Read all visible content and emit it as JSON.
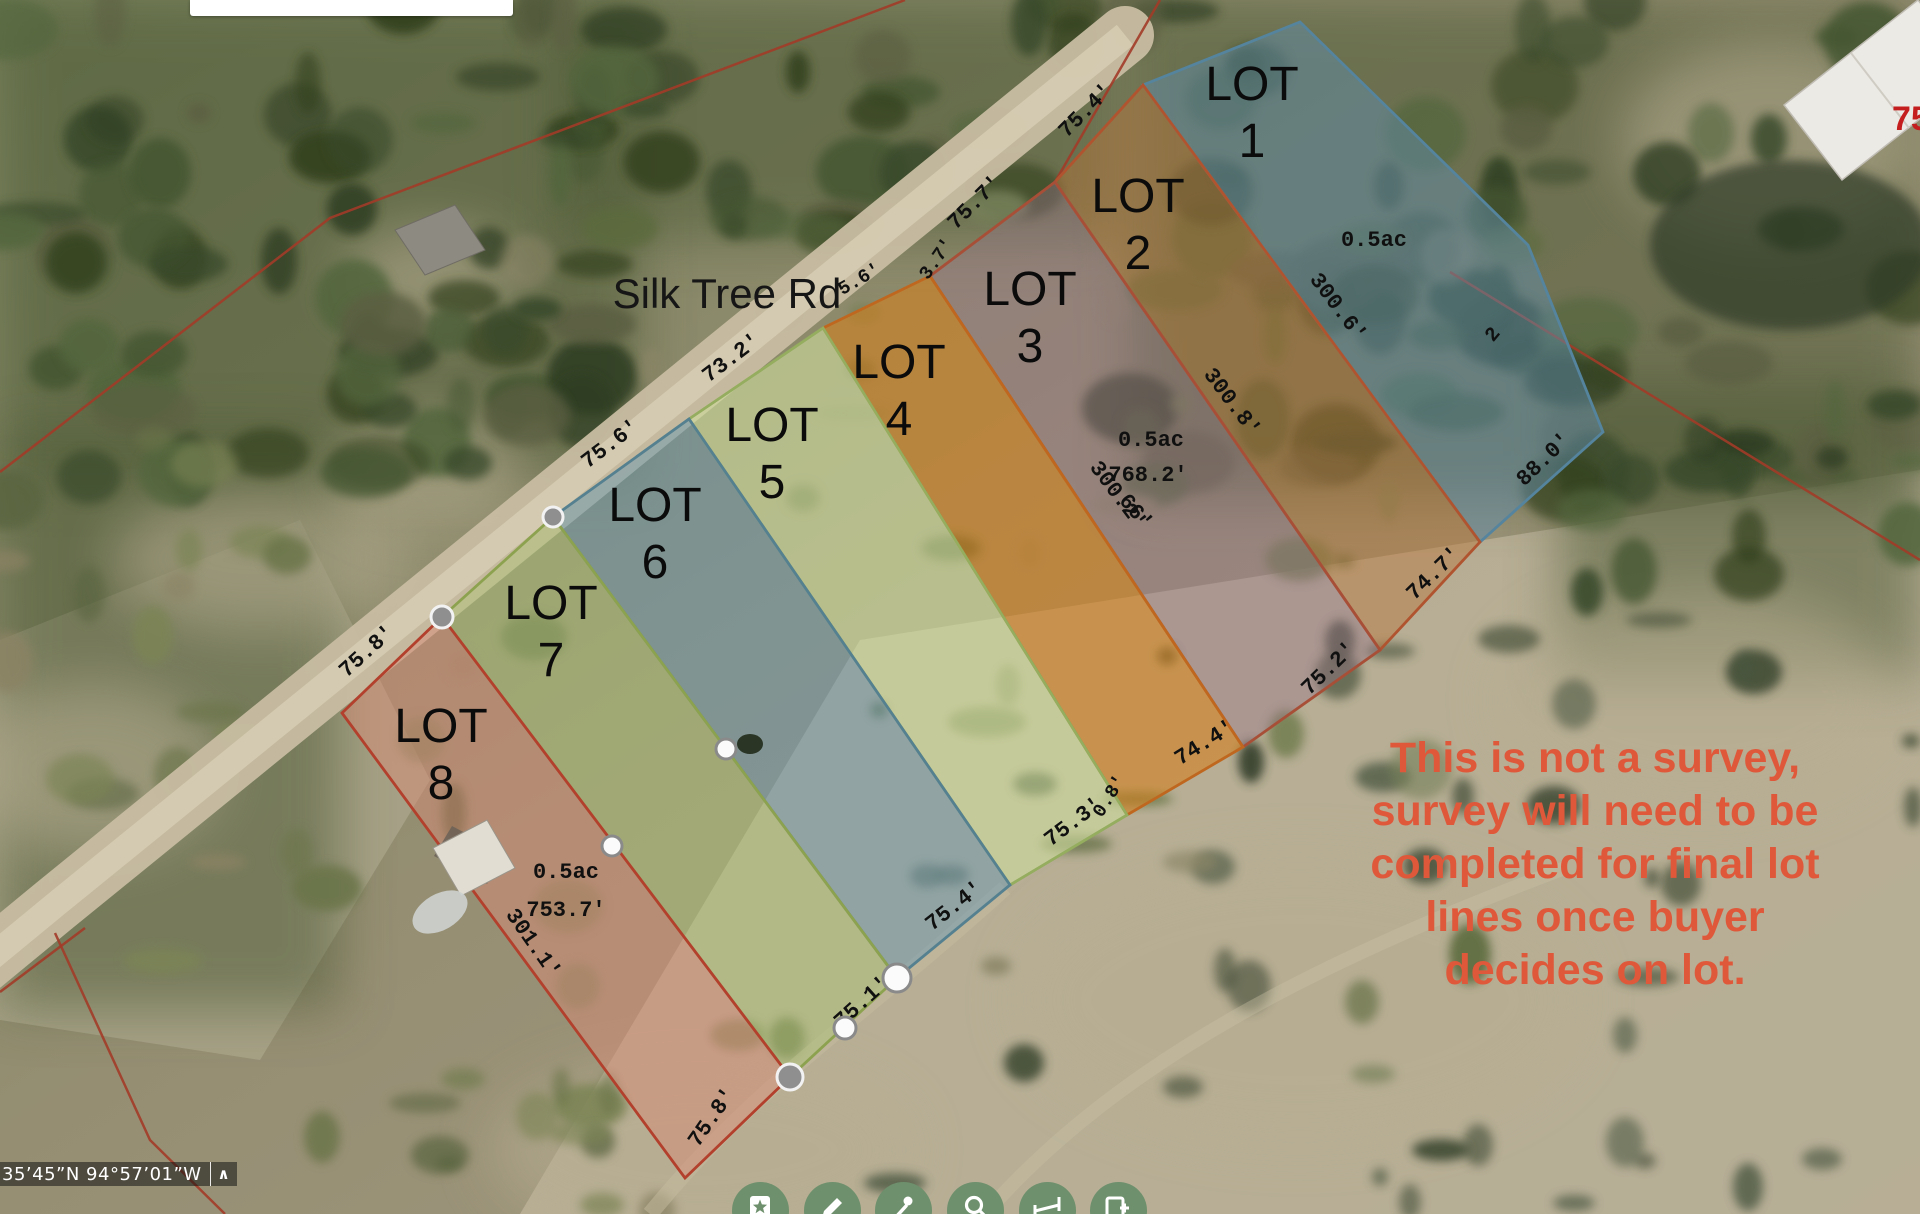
{
  "map": {
    "road_name": "Silk Tree Rd",
    "house_number": "751",
    "house_number_color": "#c41e1e",
    "disclaimer": {
      "lines": [
        "This is not a survey,",
        "survey will need to be",
        "completed for final lot",
        "lines once buyer",
        "decides on lot."
      ],
      "color": "#e0583a",
      "x": 1595,
      "first_line_y": 772,
      "line_step": 53
    },
    "boundary_line_color": "#a23b28",
    "boundary_lines": [
      [
        [
          905,
          0
        ],
        [
          330,
          218
        ],
        [
          0,
          472
        ]
      ],
      [
        [
          1160,
          0
        ],
        [
          1055,
          182
        ],
        [
          930,
          276
        ]
      ],
      [
        [
          1450,
          272
        ],
        [
          1920,
          560
        ]
      ],
      [
        [
          85,
          928
        ],
        [
          0,
          992
        ]
      ],
      [
        [
          55,
          933
        ],
        [
          150,
          1140
        ],
        [
          225,
          1214
        ]
      ]
    ],
    "lots": [
      {
        "id": 1,
        "label": "LOT",
        "number": "1",
        "area_label": "0.5ac",
        "fill": "rgba(95,140,170,0.5)",
        "stroke": "#55849e",
        "points": [
          [
            1143,
            85
          ],
          [
            1300,
            22
          ],
          [
            1528,
            245
          ],
          [
            1603,
            432
          ],
          [
            1480,
            542
          ]
        ],
        "label_x": 1252,
        "label_y": 100,
        "area_x": 1374,
        "area_y": 246
      },
      {
        "id": 2,
        "label": "LOT",
        "number": "2",
        "area_label": "",
        "fill": "rgba(186,118,58,0.45)",
        "stroke": "#b05430",
        "points": [
          [
            1055,
            182
          ],
          [
            1143,
            85
          ],
          [
            1480,
            542
          ],
          [
            1380,
            650
          ]
        ],
        "label_x": 1138,
        "label_y": 212,
        "area_x": 0,
        "area_y": 0
      },
      {
        "id": 3,
        "label": "LOT",
        "number": "3",
        "area_label": "0.5ac",
        "fill": "rgba(152,116,138,0.4)",
        "stroke": "#a84f38",
        "points": [
          [
            930,
            276
          ],
          [
            1055,
            182
          ],
          [
            1380,
            650
          ],
          [
            1243,
            747
          ]
        ],
        "label_x": 1030,
        "label_y": 305,
        "area_x": 1151,
        "area_y": 446
      },
      {
        "id": 4,
        "label": "LOT",
        "number": "4",
        "area_label": "",
        "fill": "rgba(212,127,28,0.58)",
        "stroke": "#bf671f",
        "points": [
          [
            823,
            328
          ],
          [
            930,
            276
          ],
          [
            1243,
            747
          ],
          [
            1127,
            815
          ]
        ],
        "label_x": 899,
        "label_y": 378,
        "area_x": 0,
        "area_y": 0
      },
      {
        "id": 5,
        "label": "LOT",
        "number": "5",
        "area_label": "",
        "fill": "rgba(206,221,159,0.6)",
        "stroke": "#94ad5e",
        "points": [
          [
            689,
            419
          ],
          [
            823,
            328
          ],
          [
            1127,
            815
          ],
          [
            1010,
            885
          ]
        ],
        "label_x": 772,
        "label_y": 441,
        "area_x": 0,
        "area_y": 0
      },
      {
        "id": 6,
        "label": "LOT",
        "number": "6",
        "area_label": "",
        "fill": "rgba(108,154,178,0.5)",
        "stroke": "#54808f",
        "points": [
          [
            553,
            517
          ],
          [
            689,
            419
          ],
          [
            1010,
            885
          ],
          [
            897,
            978
          ]
        ],
        "label_x": 655,
        "label_y": 521,
        "area_x": 0,
        "area_y": 0
      },
      {
        "id": 7,
        "label": "LOT",
        "number": "7",
        "area_label": "",
        "fill": "rgba(174,196,120,0.48)",
        "stroke": "#8da24f",
        "points": [
          [
            442,
            617
          ],
          [
            553,
            517
          ],
          [
            897,
            978
          ],
          [
            790,
            1077
          ]
        ],
        "label_x": 551,
        "label_y": 619,
        "area_x": 0,
        "area_y": 0
      },
      {
        "id": 8,
        "label": "LOT",
        "number": "8",
        "area_label": "0.5ac",
        "fill": "rgba(217,138,118,0.48)",
        "stroke": "#b2402c",
        "points": [
          [
            342,
            713
          ],
          [
            442,
            617
          ],
          [
            790,
            1077
          ],
          [
            685,
            1178
          ]
        ],
        "label_x": 441,
        "label_y": 742,
        "area_x": 566,
        "area_y": 878
      }
    ],
    "dimension_labels": [
      {
        "text": "75.4'",
        "x": 1090,
        "y": 115,
        "rot": -45,
        "size": 22
      },
      {
        "text": "75.7'",
        "x": 979,
        "y": 207,
        "rot": -45,
        "size": 22
      },
      {
        "text": "3.7'",
        "x": 941,
        "y": 262,
        "rot": -55,
        "size": 19
      },
      {
        "text": "5.6'",
        "x": 862,
        "y": 284,
        "rot": -30,
        "size": 19
      },
      {
        "text": "73.2'",
        "x": 735,
        "y": 363,
        "rot": -37,
        "size": 22
      },
      {
        "text": "75.6'",
        "x": 614,
        "y": 449,
        "rot": -37,
        "size": 22
      },
      {
        "text": "75.8'",
        "x": 371,
        "y": 656,
        "rot": -42,
        "size": 22
      },
      {
        "text": "300.6'",
        "x": 1333,
        "y": 311,
        "rot": 53,
        "size": 22
      },
      {
        "text": "300.8'",
        "x": 1227,
        "y": 406,
        "rot": 53,
        "size": 22
      },
      {
        "text": "768.2'",
        "x": 1148,
        "y": 481,
        "rot": 0,
        "size": 22
      },
      {
        "text": "300.2'",
        "x": 1113,
        "y": 499,
        "rot": 53,
        "size": 22
      },
      {
        "text": "66'",
        "x": 1131,
        "y": 516,
        "rot": 50,
        "size": 22
      },
      {
        "text": "88.0'",
        "x": 1548,
        "y": 464,
        "rot": -44,
        "size": 22
      },
      {
        "text": "74.7'",
        "x": 1438,
        "y": 578,
        "rot": -44,
        "size": 22
      },
      {
        "text": "75.2'",
        "x": 1333,
        "y": 673,
        "rot": -44,
        "size": 22
      },
      {
        "text": "74.4'",
        "x": 1208,
        "y": 748,
        "rot": -32,
        "size": 22
      },
      {
        "text": "0.8'",
        "x": 1114,
        "y": 799,
        "rot": -58,
        "size": 19
      },
      {
        "text": "75.3'",
        "x": 1077,
        "y": 827,
        "rot": -37,
        "size": 22
      },
      {
        "text": "75.4'",
        "x": 958,
        "y": 911,
        "rot": -38,
        "size": 22
      },
      {
        "text": "75.1'",
        "x": 866,
        "y": 1007,
        "rot": -42,
        "size": 22
      },
      {
        "text": "75.8'",
        "x": 717,
        "y": 1121,
        "rot": -55,
        "size": 22
      },
      {
        "text": "753.7'",
        "x": 566,
        "y": 916,
        "rot": 0,
        "size": 22
      },
      {
        "text": "301.1'",
        "x": 528,
        "y": 947,
        "rot": 55,
        "size": 22
      },
      {
        "text": "2",
        "x": 1497,
        "y": 338,
        "rot": -50,
        "size": 20
      }
    ],
    "vertices": [
      {
        "x": 442,
        "y": 617,
        "r": 11,
        "type": "gray"
      },
      {
        "x": 553,
        "y": 517,
        "r": 10,
        "type": "gray"
      },
      {
        "x": 790,
        "y": 1077,
        "r": 13,
        "type": "gray"
      },
      {
        "x": 897,
        "y": 978,
        "r": 14,
        "type": "white"
      },
      {
        "x": 845,
        "y": 1028,
        "r": 11,
        "type": "white"
      },
      {
        "x": 726,
        "y": 749,
        "r": 10,
        "type": "white"
      },
      {
        "x": 612,
        "y": 846,
        "r": 10,
        "type": "white"
      }
    ]
  },
  "statusbar": {
    "coordinates": "35’45”N 94°57’01”W",
    "collapse_icon": "chevron-up"
  },
  "toolbar": {
    "button_color": "#6e906c",
    "icon_color": "#ffffff",
    "buttons": [
      {
        "name": "bookmark"
      },
      {
        "name": "draw"
      },
      {
        "name": "street-view"
      },
      {
        "name": "search"
      },
      {
        "name": "measure"
      },
      {
        "name": "print"
      }
    ],
    "centers_x": [
      760,
      832,
      903,
      975,
      1047,
      1118
    ],
    "center_y": 1210
  }
}
